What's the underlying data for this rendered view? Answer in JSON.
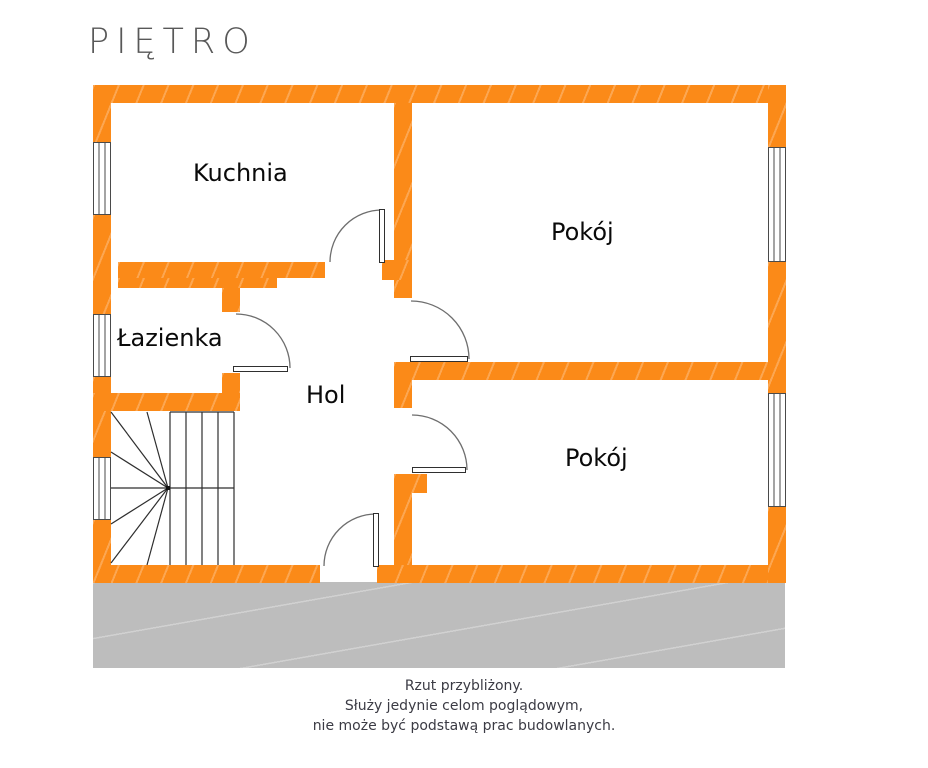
{
  "title": "PIĘTRO",
  "plan": {
    "rooms": {
      "kitchen": {
        "label": "Kuchnia"
      },
      "room_top": {
        "label": "Pokój"
      },
      "bathroom": {
        "label": "Łazienka"
      },
      "hall": {
        "label": "Hol"
      },
      "room_bottom": {
        "label": "Pokój"
      }
    }
  },
  "disclaimer": {
    "lines": [
      "Rzut przybliżony.",
      "Służy jedynie celom poglądowym,",
      "nie może być podstawą prac budowlanych."
    ]
  },
  "colors": {
    "wall_fill": "#FB8A18",
    "ground_fill": "#BDBDBD",
    "outline": "#4A4A4A",
    "room_label": "#0A0A0A",
    "title": "#585858",
    "disclaimer_text": "#3B3B44"
  }
}
